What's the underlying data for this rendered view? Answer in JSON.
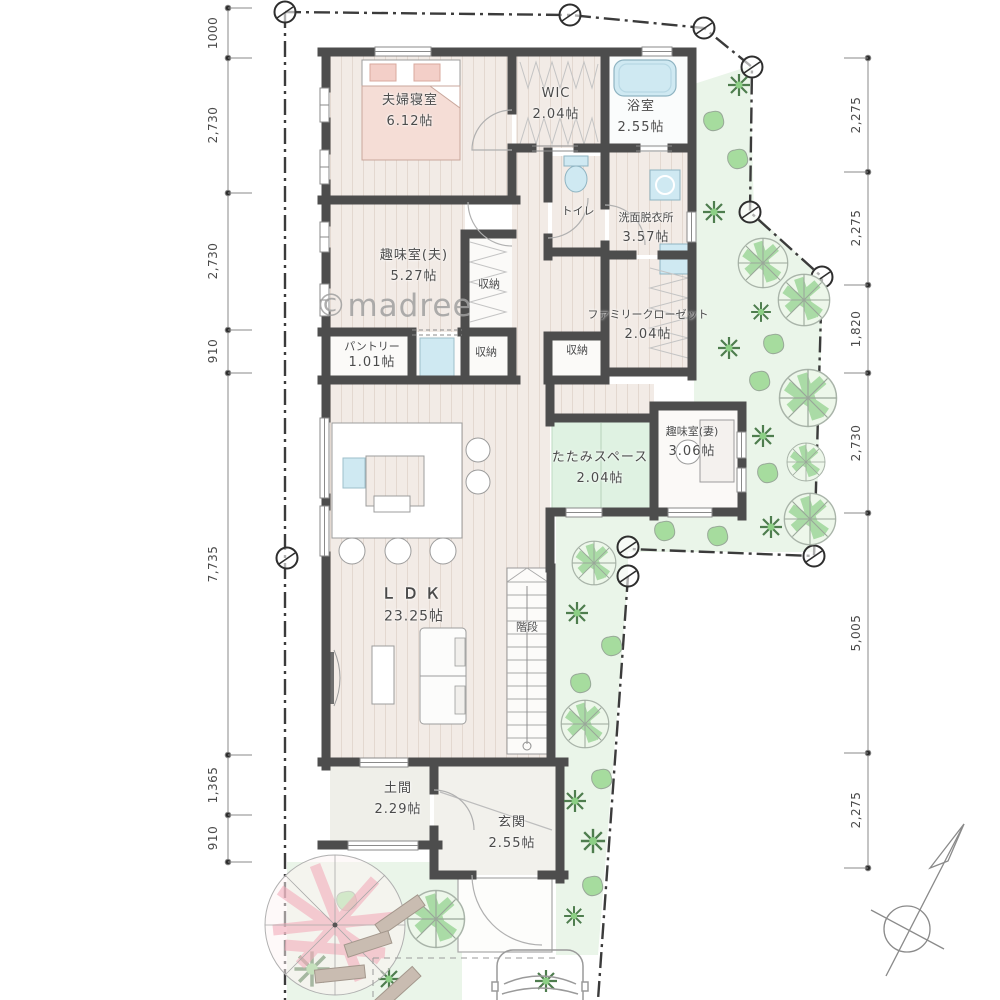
{
  "watermark": "©madree",
  "plan": {
    "rooms": {
      "bedroom": {
        "name": "夫婦寝室",
        "size": "6.12帖"
      },
      "wic": {
        "name": "WIC",
        "size": "2.04帖"
      },
      "bath": {
        "name": "浴室",
        "size": "2.55帖"
      },
      "toilet": {
        "name": "トイレ"
      },
      "washroom": {
        "name": "洗面脱衣所",
        "size": "3.57帖"
      },
      "hobby_husband": {
        "name": "趣味室(夫)",
        "size": "5.27帖"
      },
      "closet_hobby": {
        "name": "収納"
      },
      "pantry": {
        "name": "パントリー",
        "size": "1.01帖"
      },
      "closet_south": {
        "name": "収納"
      },
      "closet_hall": {
        "name": "収納"
      },
      "family_closet": {
        "name": "ファミリークローゼット",
        "size": "2.04帖"
      },
      "tatami": {
        "name": "たたみスペース",
        "size": "2.04帖"
      },
      "hobby_wife": {
        "name": "趣味室(妻)",
        "size": "3.06帖"
      },
      "ldk": {
        "name": "ＬＤＫ",
        "size": "23.25帖"
      },
      "stairs": {
        "name": "階段"
      },
      "doma": {
        "name": "土間",
        "size": "2.29帖"
      },
      "genkan": {
        "name": "玄関",
        "size": "2.55帖"
      }
    },
    "dimensions": {
      "left": [
        "1000",
        "2,730",
        "2,730",
        "910",
        "7,735",
        "1,365",
        "910"
      ],
      "right": [
        "2,275",
        "2,275",
        "1,820",
        "2,730",
        "5,005",
        "2,275"
      ]
    },
    "colors": {
      "wall": "#4d4d4d",
      "wood_floor": "#f2ebe6",
      "tatami": "#dff2e2",
      "water_fixture": "#cfe9f2",
      "garden": "#eaf5e9",
      "foliage": "#8fd08a",
      "sakura": "#f3aebc",
      "stepping_stone": "#c9bcb1",
      "bed_linen": "#f5ddd6"
    }
  }
}
